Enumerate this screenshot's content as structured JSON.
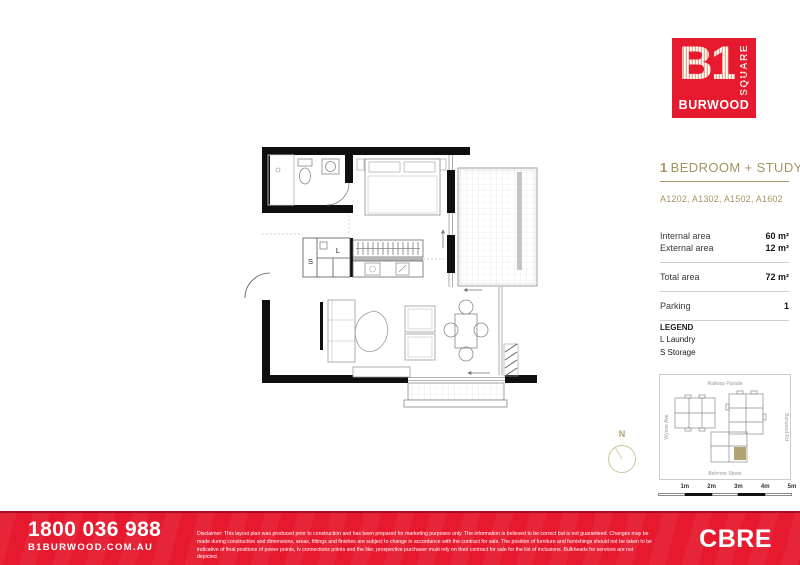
{
  "logo": {
    "b1": "B1",
    "square": "SQUARE",
    "burwood": "BURWOOD"
  },
  "panel": {
    "title_number": "1",
    "title_text": "BEDROOM + STUDY",
    "apartments": "A1202, A1302, A1502, A1602",
    "rows": [
      {
        "label": "Internal area",
        "value": "60 m²"
      },
      {
        "label": "External area",
        "value": "12 m²"
      }
    ],
    "total_row": {
      "label": "Total area",
      "value": "72 m²"
    },
    "parking_row": {
      "label": "Parking",
      "value": "1"
    },
    "legend": {
      "title": "LEGEND",
      "items": [
        "L Laundry",
        "S Storage"
      ]
    }
  },
  "plan": {
    "storage_label": "S",
    "laundry_label": "L"
  },
  "compass": {
    "north_label": "N"
  },
  "map": {
    "street_top": "Railway Parade",
    "street_right": "Burwood Rd",
    "street_bottom": "Belmore Street",
    "street_left": "Wynne Ave"
  },
  "scale_bar": {
    "labels": [
      "1m",
      "2m",
      "3m",
      "4m",
      "5m"
    ]
  },
  "footer": {
    "phone": "1800 036 988",
    "website": "B1BURWOOD.COM.AU",
    "disclaimer": "Disclaimer: This layout plan was produced prior to construction and has been prepared for marketing purposes only. The information is believed to be correct but is not guaranteed. Changes may be made during construction and dimensions, areas, fittings and finishes are subject to change in accordance with the contract for sale. The position of furniture and furnishings should not be taken to be indicative of final positions of power points, tv connections points and the like; prospective purchaser must rely on their contract for sale for the list of inclusions. Bulkheads for services are not depicted.",
    "brand": "CBRE"
  },
  "colors": {
    "brand_red": "#e6192e",
    "gold": "#a6935f",
    "unit_highlight": "#b3a372"
  }
}
